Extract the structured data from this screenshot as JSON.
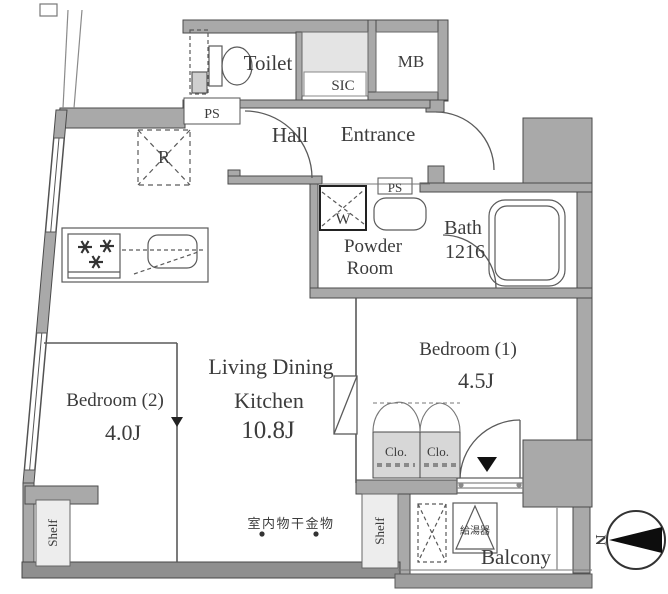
{
  "floorplan": {
    "labels": {
      "toilet": "Toilet",
      "sic": "SIC",
      "mb": "MB",
      "ps_top": "PS",
      "ps_mid": "PS",
      "hall": "Hall",
      "entrance": "Entrance",
      "washer": "W",
      "powder_line1": "Powder",
      "powder_line2": "Room",
      "bath": "Bath",
      "bath_size": "1216",
      "refrigerator": "R",
      "ldk_line1": "Living Dining",
      "ldk_line2": "Kitchen",
      "ldk_size": "10.8J",
      "bedroom1": "Bedroom (1)",
      "bedroom1_size": "4.5J",
      "bedroom2": "Bedroom (2)",
      "bedroom2_size": "4.0J",
      "closet1": "Clo.",
      "closet2": "Clo.",
      "shelf_left": "Shelf",
      "shelf_right": "Shelf",
      "indoor_drying_hardware": "室内物干金物",
      "water_heater": "給湯器",
      "balcony": "Balcony",
      "compass_north": "N"
    },
    "colors": {
      "wall": "#a9a9a9",
      "wall_dark": "#8f8f8f",
      "outline": "#4a4a4a",
      "light_fill": "#e4e4e4",
      "closet_fill": "#d7d7d7",
      "text": "#3c3c3c"
    }
  }
}
